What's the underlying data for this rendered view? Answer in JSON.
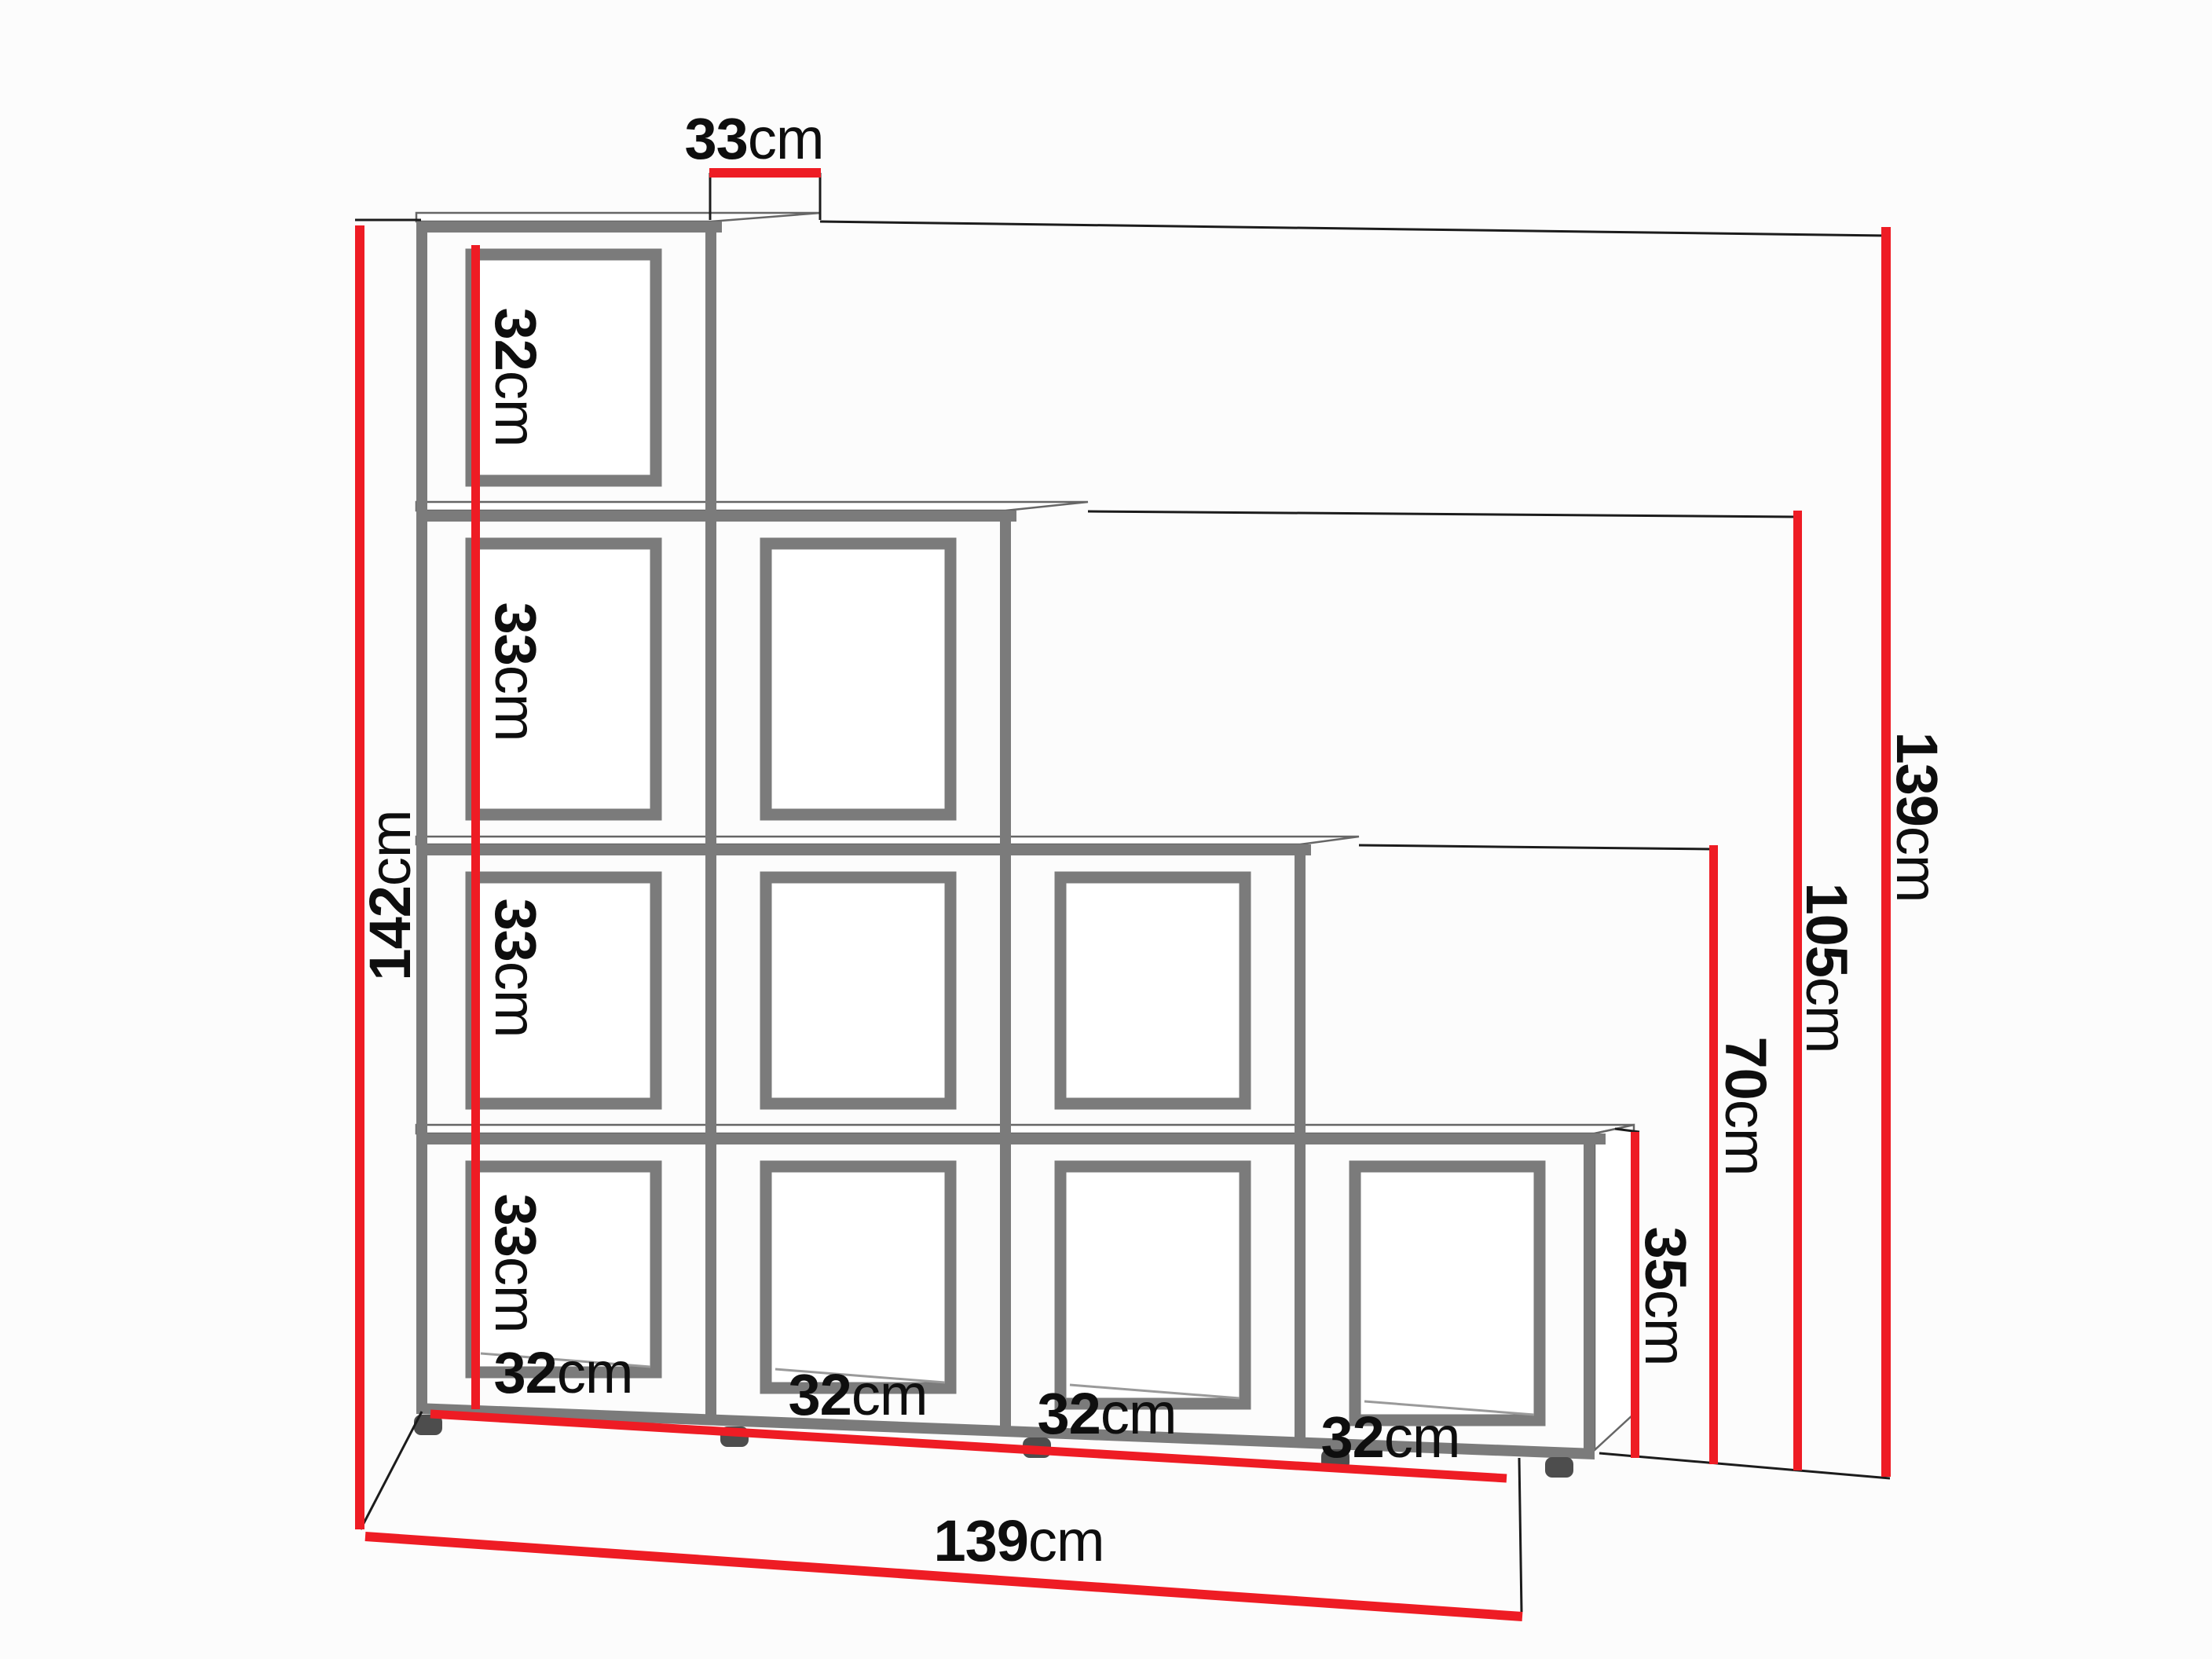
{
  "diagram": {
    "type": "furniture-dimension-drawing",
    "subject": "Stepped staircase shelf unit with 4 columns of cubbies (4/3/2/1 cells)",
    "colors": {
      "dimension_red": "#ee1c24",
      "structure_gray": "#7b7b7b",
      "text": "#0e0e0e",
      "background": "#fcfcfc"
    },
    "labels": {
      "top_depth": {
        "value": "33",
        "unit": "cm"
      },
      "left_total_height": {
        "value": "142",
        "unit": "cm"
      },
      "cell_heights": [
        {
          "value": "32",
          "unit": "cm"
        },
        {
          "value": "33",
          "unit": "cm"
        },
        {
          "value": "33",
          "unit": "cm"
        },
        {
          "value": "33",
          "unit": "cm"
        }
      ],
      "bottom_cell_widths": [
        {
          "value": "32",
          "unit": "cm"
        },
        {
          "value": "32",
          "unit": "cm"
        },
        {
          "value": "32",
          "unit": "cm"
        },
        {
          "value": "32",
          "unit": "cm"
        }
      ],
      "bottom_total_width": {
        "value": "139",
        "unit": "cm"
      },
      "step_heights": [
        {
          "value": "35",
          "unit": "cm"
        },
        {
          "value": "70",
          "unit": "cm"
        },
        {
          "value": "105",
          "unit": "cm"
        },
        {
          "value": "139",
          "unit": "cm"
        }
      ]
    }
  }
}
